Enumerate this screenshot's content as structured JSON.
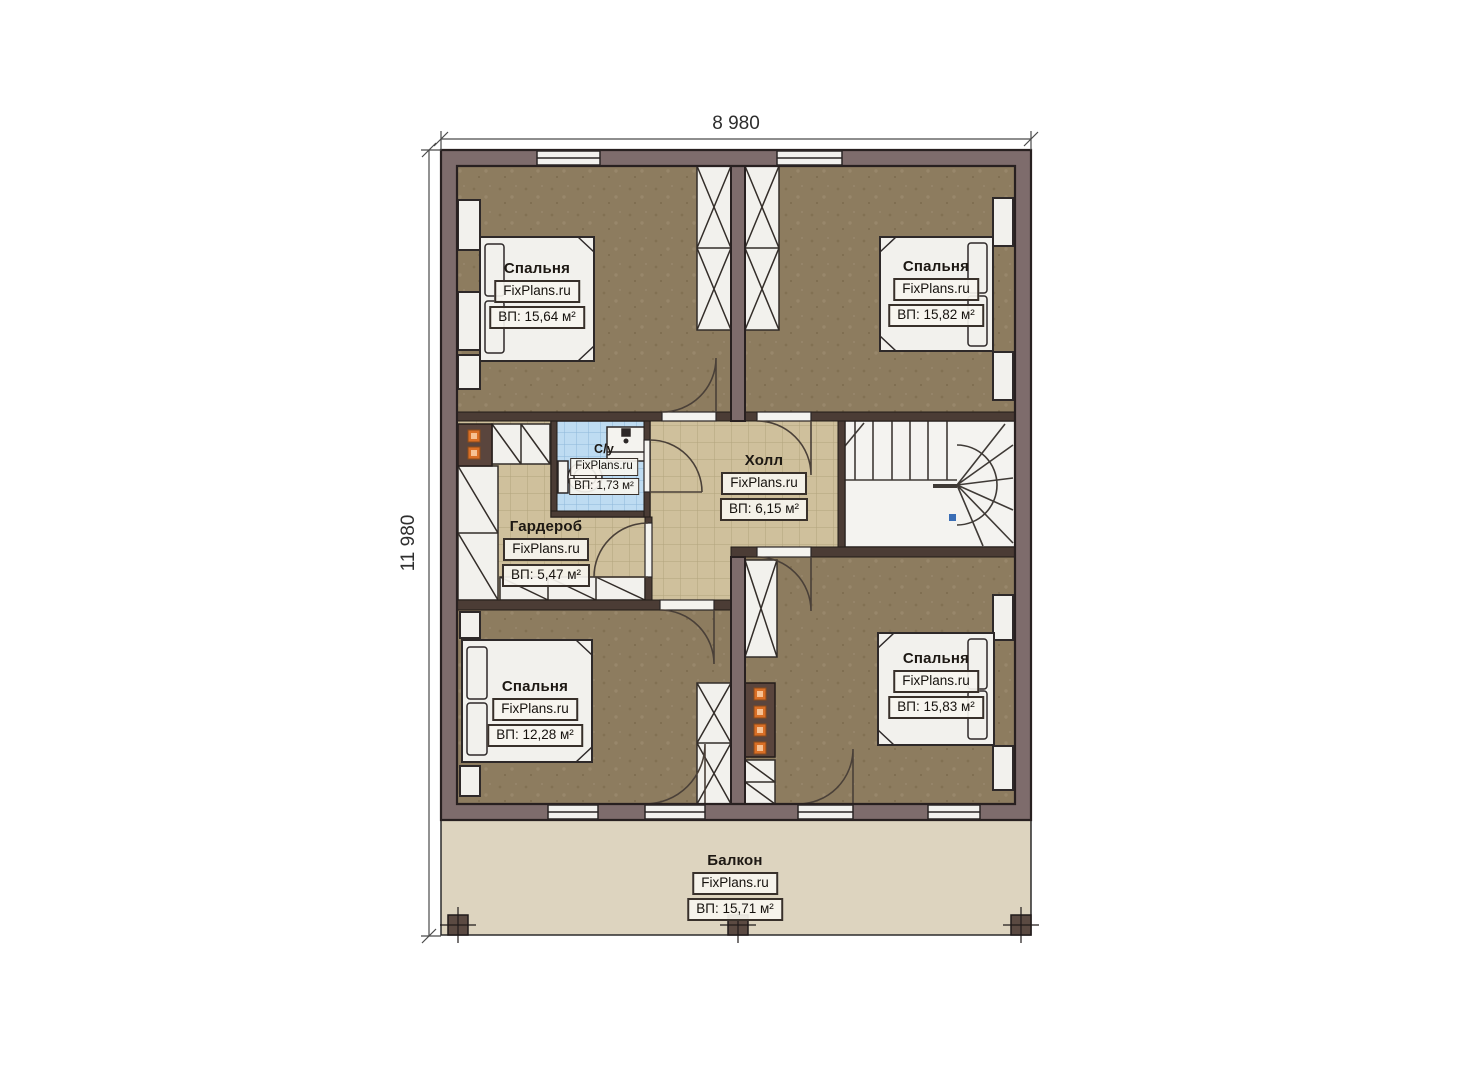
{
  "plan": {
    "watermark": "FixPlans.ru",
    "dimensions": {
      "width": "8 980",
      "height": "11 980"
    },
    "rooms": [
      {
        "key": "bedroom-top-left",
        "name": "Спальня",
        "area": "ВП: 15,64 м²"
      },
      {
        "key": "bedroom-top-right",
        "name": "Спальня",
        "area": "ВП: 15,82 м²"
      },
      {
        "key": "bathroom",
        "name": "С/у",
        "area": "ВП: 1,73 м²"
      },
      {
        "key": "wardrobe",
        "name": "Гардероб",
        "area": "ВП: 5,47 м²"
      },
      {
        "key": "hall",
        "name": "Холл",
        "area": "ВП: 6,15 м²"
      },
      {
        "key": "bedroom-bottom-left",
        "name": "Спальня",
        "area": "ВП: 12,28 м²"
      },
      {
        "key": "bedroom-bottom-right",
        "name": "Спальня",
        "area": "ВП: 15,83 м²"
      },
      {
        "key": "balcony",
        "name": "Балкон",
        "area": "ВП: 15,71 м²"
      }
    ],
    "colors": {
      "wall": "#7e6c6c",
      "wall_outline": "#2a2222",
      "interior_wall": "#4b3c35",
      "bedroom_floor": "#8d7c5f",
      "tile_floor": "#cfc09c",
      "bath_floor": "#bedcf2",
      "balcony_floor": "#ddd4bf",
      "furniture": "#f2f1ed",
      "chimney_orange": "#e0701f"
    }
  }
}
